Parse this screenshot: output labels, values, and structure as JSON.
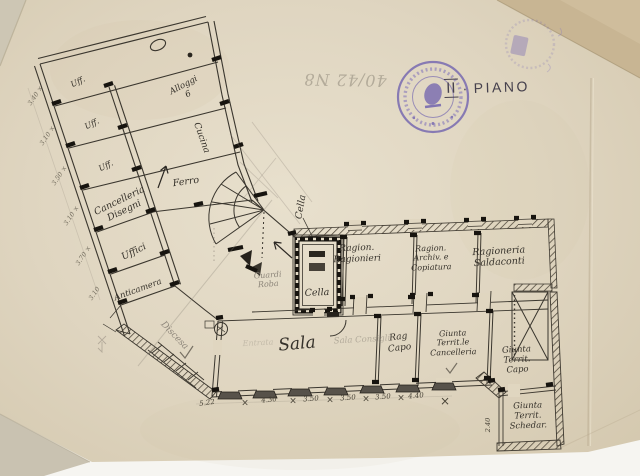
{
  "document_kind": "scanned hand-drawn floor plan",
  "annotations": {
    "floor_numeral": "II",
    "floor_sep": "·",
    "floor_word": "PIANO",
    "inverted_number": "40/42 N8"
  },
  "stamp": {
    "shape": "round",
    "color": "#7466b0",
    "legible": false
  },
  "colors": {
    "paper": "#ddd3bd",
    "ink": "#36322b",
    "pencil": "#8d867a",
    "stamp": "#7466b0"
  },
  "plan": {
    "wing_rooms": [
      {
        "id": "uff-a",
        "label": "Uff."
      },
      {
        "id": "uff-b",
        "label": "Uff."
      },
      {
        "id": "uff-c",
        "label": "Uff."
      },
      {
        "id": "alloggi",
        "label": "Alloggi\n6"
      },
      {
        "id": "cucina",
        "label": "Cucina"
      },
      {
        "id": "cancelleria-disegni",
        "label": "Cancelleria\nDisegni"
      },
      {
        "id": "uffici",
        "label": "Uffici"
      },
      {
        "id": "anticamera",
        "label": "Anticamera"
      },
      {
        "id": "ferro",
        "label": "Ferro"
      }
    ],
    "center_rooms": [
      {
        "id": "cella-callout",
        "label": "Cella"
      },
      {
        "id": "guardaroba",
        "label": "Guardi\nRoba"
      },
      {
        "id": "cella",
        "label": "Cella"
      }
    ],
    "north_rooms": [
      {
        "id": "ragionieri",
        "label": "Ragion.\nRagionieri"
      },
      {
        "id": "archivio",
        "label": "Ragion.\nArchiv. e\nCopiatura"
      },
      {
        "id": "saldaconti",
        "label": "Ragioneria\nSaldaconti"
      }
    ],
    "south_rooms": [
      {
        "id": "sala",
        "label": "Sala"
      },
      {
        "id": "sala-pencil",
        "label": "Sala Consigli"
      },
      {
        "id": "rag-capo",
        "label": "Rag\nCapo"
      },
      {
        "id": "giunta-cancelleria",
        "label": "Giunta\nTerrit.le\nCancelleria"
      },
      {
        "id": "giunta-capo",
        "label": "Giunta\nTerrit.\nCapo"
      },
      {
        "id": "giunta-schedario",
        "label": "Giunta\nTerrit.\nSchedar."
      }
    ],
    "notes": [
      {
        "id": "discesa",
        "label": "Discesa"
      },
      {
        "id": "entrata",
        "label": "Entrata"
      }
    ],
    "dimensions": {
      "mark": "×",
      "bottom": [
        "5.22",
        "4.30",
        "3.50",
        "3.50",
        "3.50",
        "4.40"
      ],
      "left": [
        "3.40 ×",
        "3.10 ×",
        "3.50 ×",
        "3.10 ×",
        "3.70 ×",
        "3.10"
      ],
      "schedario_width": "2.40"
    }
  }
}
